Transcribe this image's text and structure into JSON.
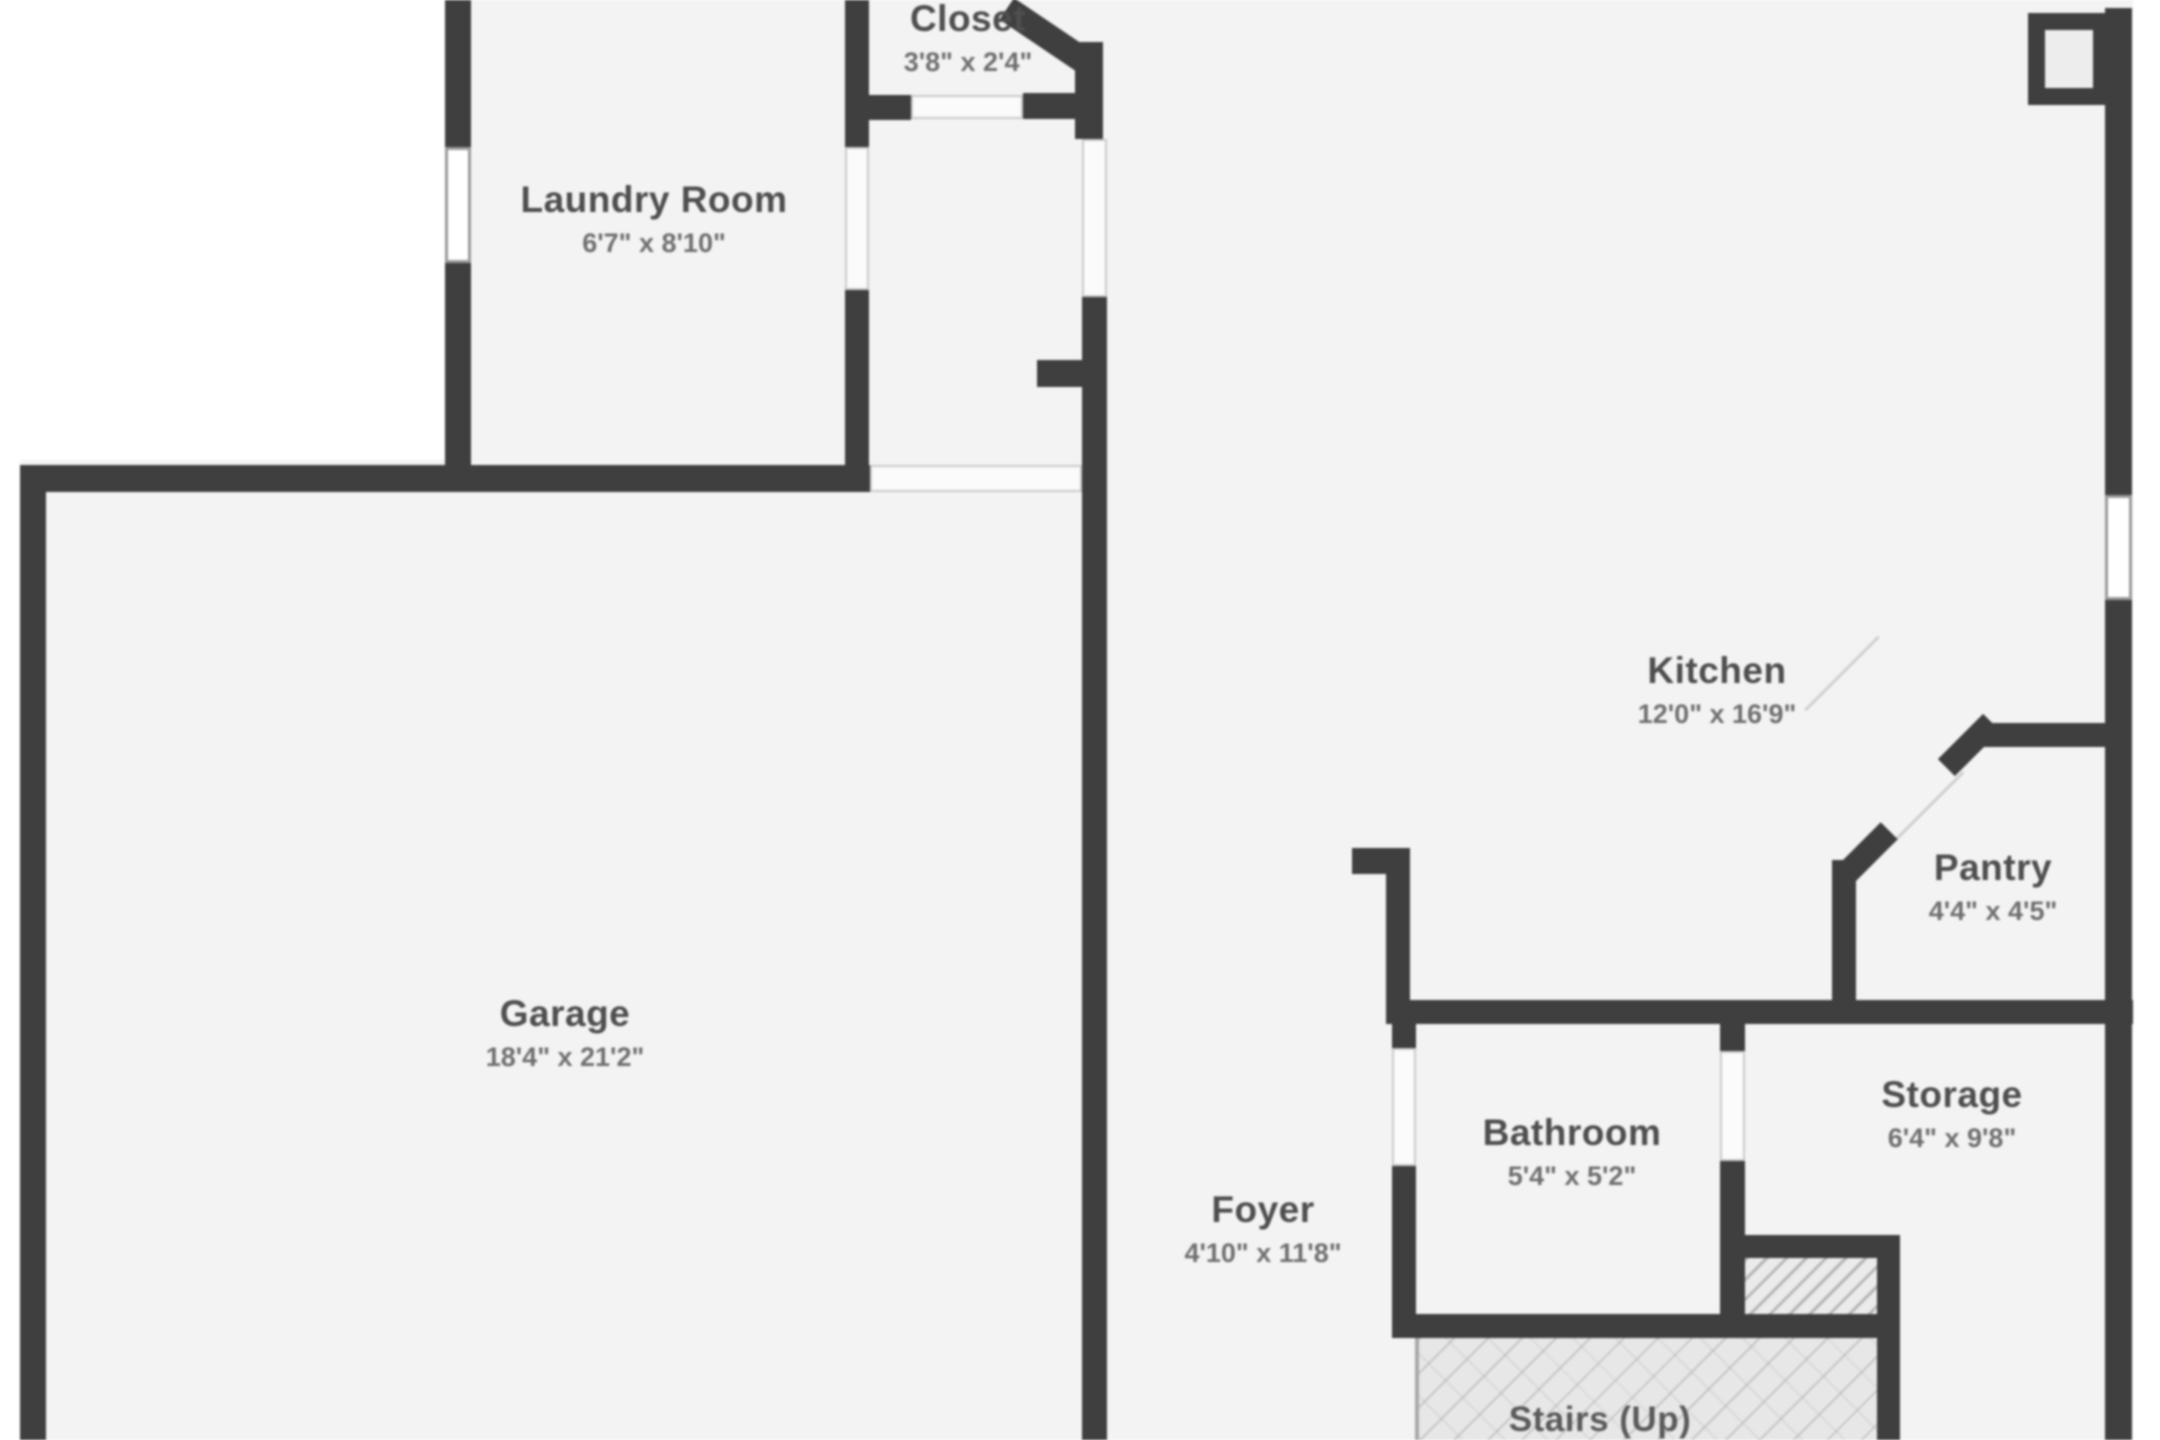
{
  "rooms": {
    "closet": {
      "name": "Closet",
      "dims": "3'8\" x 2'4\""
    },
    "laundry": {
      "name": "Laundry Room",
      "dims": "6'7\" x 8'10\""
    },
    "kitchen": {
      "name": "Kitchen",
      "dims": "12'0\" x 16'9\""
    },
    "pantry": {
      "name": "Pantry",
      "dims": "4'4\" x 4'5\""
    },
    "garage": {
      "name": "Garage",
      "dims": "18'4\" x 21'2\""
    },
    "bathroom": {
      "name": "Bathroom",
      "dims": "5'4\" x 5'2\""
    },
    "storage": {
      "name": "Storage",
      "dims": "6'4\" x 9'8\""
    },
    "foyer": {
      "name": "Foyer",
      "dims": "4'10\" x 11'8\""
    },
    "stairs": {
      "name": "Stairs (Up)"
    }
  },
  "colors": {
    "wall": "#3f3f3f",
    "floor": "#f3f3f3",
    "room_name_text": "#4e4e4e",
    "room_dims_text": "#6f6f6f",
    "background": "#ffffff"
  }
}
